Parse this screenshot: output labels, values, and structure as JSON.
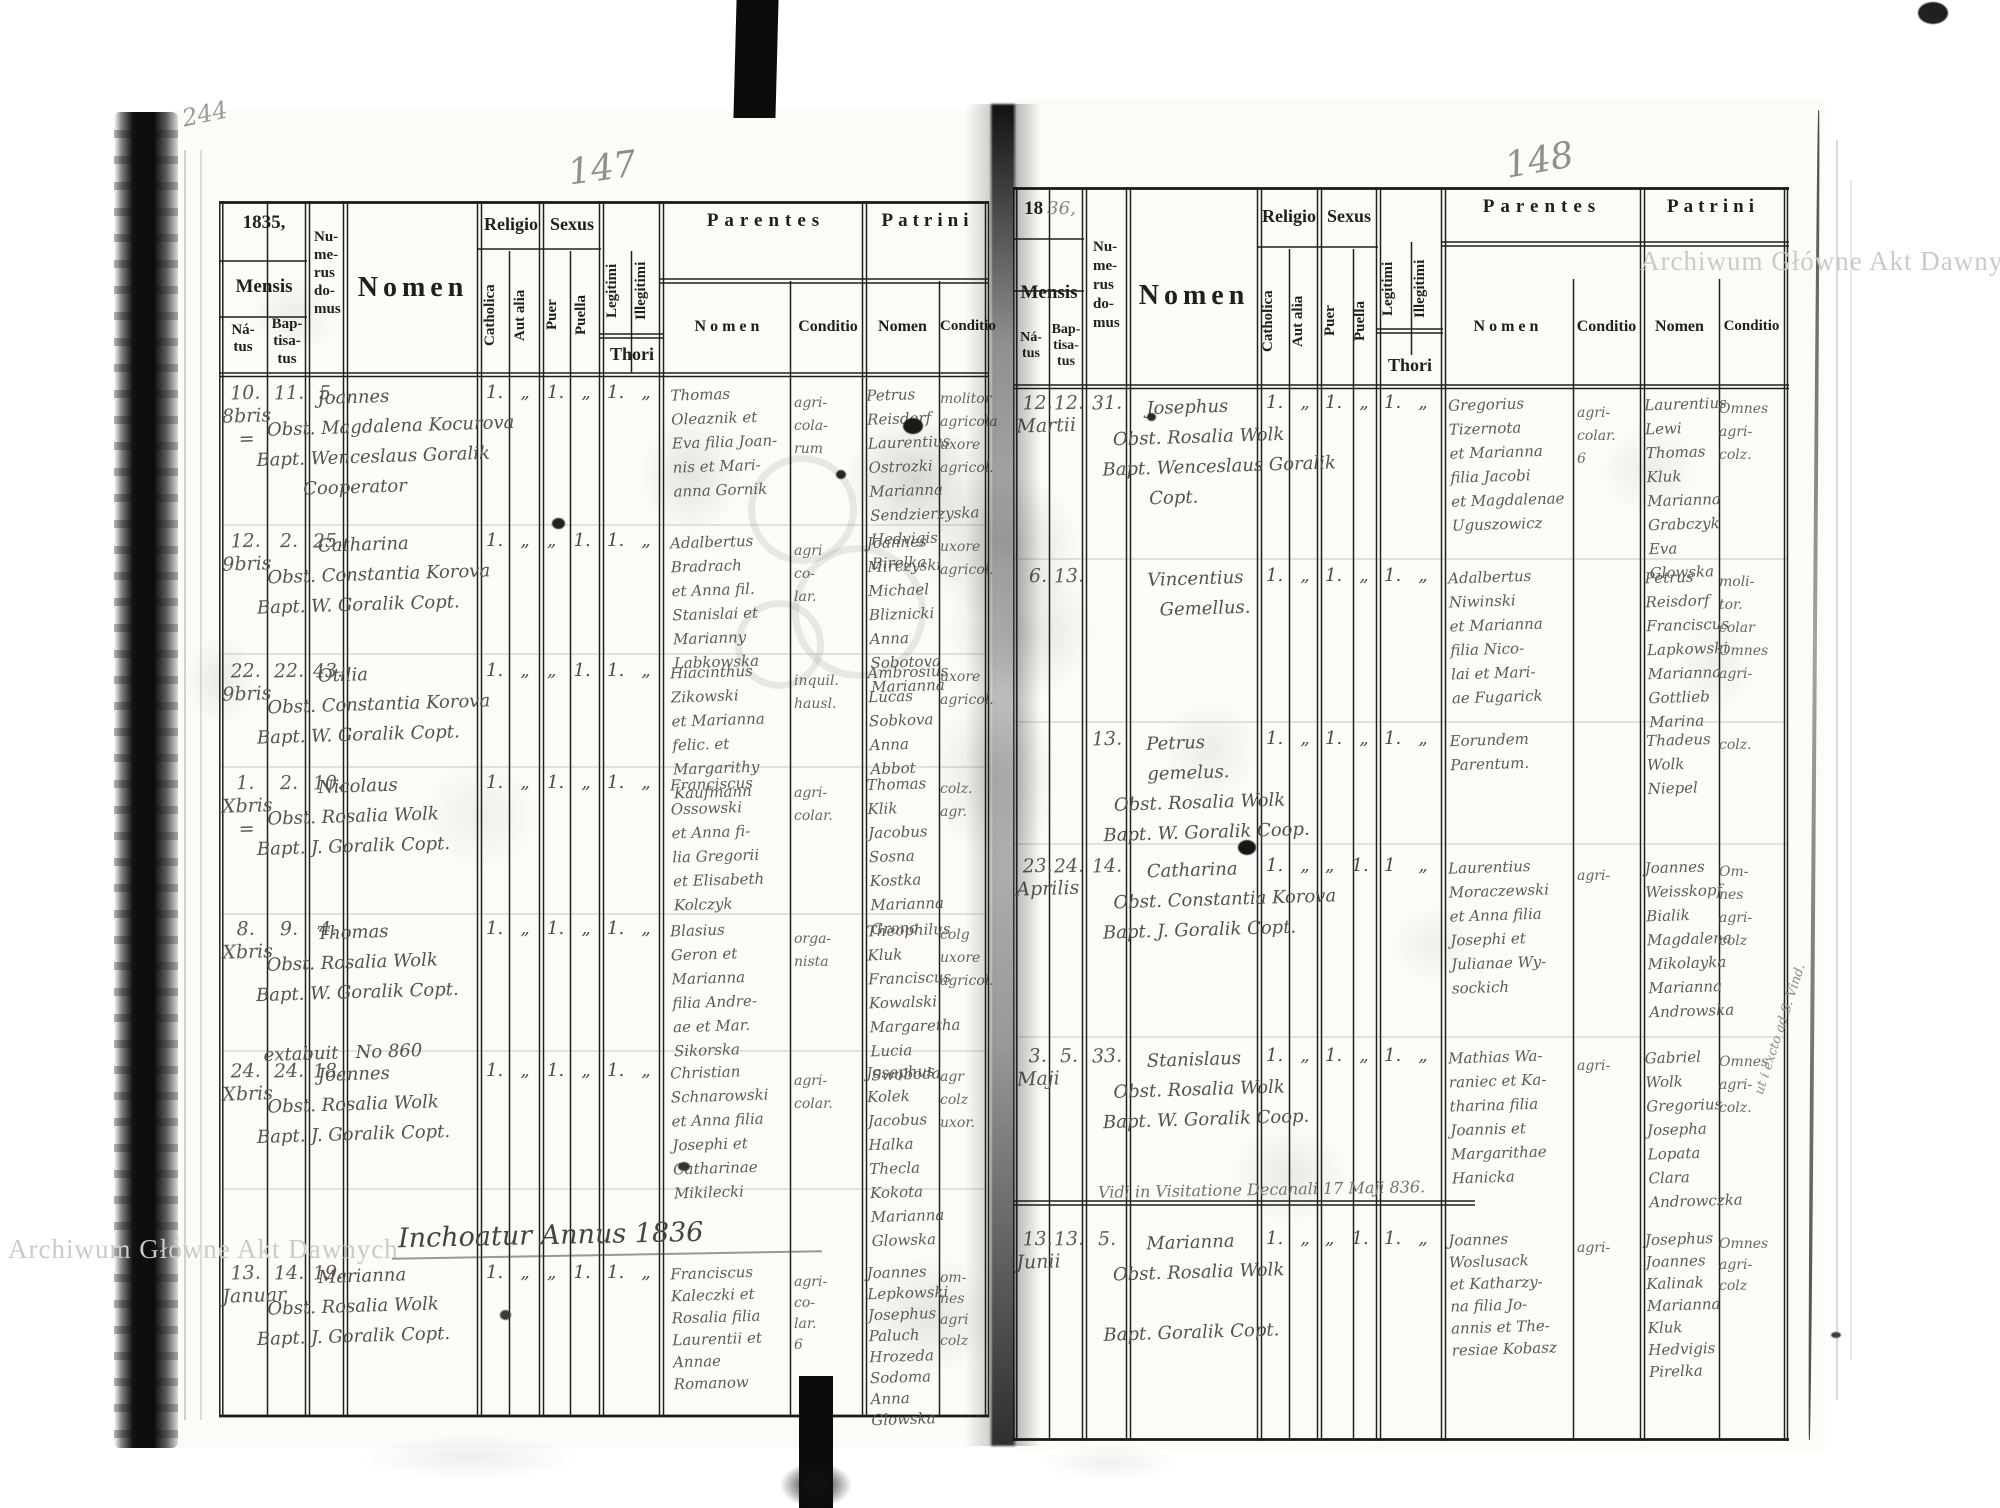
{
  "archive_watermark": {
    "text": "Archiwum Główne Akt Dawnych"
  },
  "headers": {
    "mensis": "Mensis",
    "natus": "Ná-\ntus",
    "baptisatus": "Bap-\ntisa-\ntus",
    "numerus_domus": "Nu-\nme-\nrus\ndo-\nmus",
    "nomen": "Nomen",
    "religio": "Religio",
    "catholica": "Catholica",
    "aut_alia": "Aut alia",
    "sexus": "Sexus",
    "puer": "Puer",
    "puella": "Puella",
    "legitimi": "Legitimi",
    "illegitimi": "Illegitimi",
    "thori": "Thori",
    "parentes": "Parentes",
    "patrini": "Patrini",
    "sub_nomen": "Nomen",
    "sub_conditio": "Conditio"
  },
  "page_left": {
    "corner_mark": "244",
    "page_number": "147",
    "year": "1835,",
    "section_note": "Inchoatur Annus 1836",
    "rows": [
      {
        "natus": "10.\n8bris\n=",
        "baptisatus": "11.",
        "domus": "5.",
        "entry": "           Joannes\n  Obst. Magdalena Kocurova\nBapt. Wenceslaus Goralik\n        Cooperator",
        "religio": "1.   „",
        "sexus": "1.   „",
        "thori": "1.   „",
        "parentes": "Thomas\nOleaznik et\nEva filia Joan-\nnis et Mari-\nanna Gornik",
        "parentes_conditio": "agri-\ncola-\nrum",
        "patrini": "Petrus\nReisdorf\nLaurentius\nOstrozki\nMarianna\nSendzierzyska\nHedvigis\nBirelka",
        "patrini_conditio": "molitor\nagricola\nuxore\nagricol."
      },
      {
        "natus": "12.\n9bris",
        "baptisatus": "2.",
        "domus": "25.",
        "entry": "           Catharina\n  Obst. Constantia Korova\nBapt. W. Goralik Copt.",
        "religio": "1.   „",
        "sexus": "„   1.",
        "thori": "1.   „",
        "parentes": "Adalbertus\nBradrach\net Anna fil.\nStanislai et\nMarianny\nLabkowska",
        "parentes_conditio": "agri\nco-\nlar.",
        "patrini": "Joannes\nMirczyski\nMichael\nBliznicki\nAnna\nSobotova\nMarianna",
        "patrini_conditio": "uxore\nagricol."
      },
      {
        "natus": "22.\n9bris",
        "baptisatus": "22.",
        "domus": "43.",
        "entry": "           Otilia\n  Obst. Constantia Korova\nBapt. W. Goralik Copt.",
        "religio": "1.   „",
        "sexus": "„   1.",
        "thori": "1.   „",
        "parentes": "Hiacinthus\nZikowski\net Marianna\nfelic. et\nMargarithy\nKaufmann",
        "parentes_conditio": "inquil.\nhausl.",
        "patrini": "Ambrosius\nLucas\nSobkova\nAnna\nAbbot",
        "patrini_conditio": "uxore\nagricol."
      },
      {
        "natus": "1.\nXbris\n=",
        "baptisatus": "2.",
        "domus": "10.",
        "entry": "           Nicolaus\n  Obst. Rosalia Wolk\nBapt. J. Goralik Copt.",
        "religio": "1.   „",
        "sexus": "1.   „",
        "thori": "1.   „",
        "parentes": "Franciscus\nOssowski\net Anna fi-\nlia Gregorii\net Elisabeth\nKolczyk",
        "parentes_conditio": "agri-\ncolar.",
        "patrini": "Thomas\nKlik\nJacobus\nSosna\nKostka\nMarianna\nGrono",
        "patrini_conditio": "colz.\nagr."
      },
      {
        "natus": "8.\nXbris",
        "baptisatus": "9.",
        "domus": "4.",
        "entry": "           Thomas\n  Obst. Rosalia Wolk\nBapt. W. Goralik Copt.\n\n extabuit   No 860",
        "religio": "1.   „",
        "sexus": "1.   „",
        "thori": "1.   „",
        "parentes": "Blasius\nGeron et\nMarianna\nfilia Andre-\nae et Mar.\nSikorska",
        "parentes_conditio": "orga-\nnista",
        "patrini": "Theophilus\nKluk\nFranciscus\nKowalski\nMargaretha\nLucia\nSwoboda",
        "patrini_conditio": "colg\nuxore\nagricol."
      },
      {
        "natus": "24.\nXbris",
        "baptisatus": "24.",
        "domus": "18.",
        "entry": "           Joannes\n  Obst. Rosalia Wolk\nBapt. J. Goralik Copt.",
        "religio": "1.   „",
        "sexus": "1.   „",
        "thori": "1.   „",
        "parentes": "Christian\nSchnarowski\net Anna filia\nJosephi et\nCatharinae\nMikilecki",
        "parentes_conditio": "agri-\ncolar.",
        "patrini": "Josephus\nKolek\nJacobus\nHalka\nThecla\nKokota\nMarianna\nGlowska",
        "patrini_conditio": "agr\ncolz\nuxor."
      },
      {
        "natus": "13.\nJanuar",
        "baptisatus": "14.",
        "domus": "19.",
        "entry": "           Marianna\n  Obst. Rosalia Wolk\nBapt. J. Goralik Copt.",
        "religio": "1.   „",
        "sexus": "„   1.",
        "thori": "1.   „",
        "parentes": "Franciscus\nKaleczki et\nRosalia filia\nLaurentii et\nAnnae\nRomanow",
        "parentes_conditio": "agri-\nco-\nlar.\n6",
        "patrini": "Joannes\nLepkowski\nJosephus\nPaluch\nHrozeda\nSodoma\nAnna\nGlowska",
        "patrini_conditio": "om-\nnes\nagri\ncolz"
      }
    ]
  },
  "page_right": {
    "page_number": "148",
    "year_printed": "18",
    "year_hand": "36,",
    "visitation_note": "Vidi in Visitatione Decanali 17 Maji 836.",
    "margin_note": "ut i excto ad S. Vind.",
    "rows": [
      {
        "natus": "12.\nMartii",
        "baptisatus": "12.",
        "domus": "31.",
        "entry": "        Josephus\n  Obst. Rosalia Wolk\nBapt. Wenceslaus Goralik\n        Copt.",
        "religio": "1.   „",
        "sexus": "1.   „",
        "thori": "1.   „",
        "parentes": "Gregorius\nTizernota\net Marianna\nfilia Jacobi\net Magdalenae\nUguszowicz",
        "parentes_conditio": "agri-\ncolar.\n6",
        "patrini": "Laurentius\nLewi\nThomas\nKluk\nMarianna\nGrabczyk\nEva\nGlowska",
        "patrini_conditio": "Omnes\nagri-\ncolz."
      },
      {
        "natus": "6.",
        "baptisatus": "13.",
        "domus": "",
        "entry": "        Vincentius\n          Gemellus.",
        "religio": "1.   „",
        "sexus": "1.   „",
        "thori": "1.   „",
        "parentes": "Adalbertus\nNiwinski\net Marianna\nfilia Nico-\nlai et Mari-\nae Fugarick",
        "parentes_conditio": "",
        "patrini": "Petrus\nReisdorf\nFranciscus\nLapkowski\nMarianna\nGottlieb\nMarina",
        "patrini_conditio": "moli-\ntor.\ncolar\nOmnes\nagri-"
      },
      {
        "natus": "",
        "baptisatus": "",
        "domus": "13.",
        "entry": "        Petrus\n        gemelus.\n  Obst. Rosalia Wolk\nBapt. W. Goralik Coop.",
        "religio": "1.   „",
        "sexus": "1.   „",
        "thori": "1.   „",
        "parentes": "Eorundem\nParentum.",
        "parentes_conditio": "",
        "patrini": "Thadeus\nWolk\nNiepel",
        "patrini_conditio": "colz."
      },
      {
        "natus": "23.\nAprilis",
        "baptisatus": "24.",
        "domus": "14.",
        "entry": "        Catharina\n  Obst. Constantia Korova\nBapt. J. Goralik Copt.",
        "religio": "1.   „",
        "sexus": "„   1.",
        "thori": "1    „",
        "parentes": "Laurentius\nMoraczewski\net Anna filia\nJosephi et\nJulianae Wy-\nsockich",
        "parentes_conditio": "agri-",
        "patrini": "Joannes\nWeisskopf\nBialik\nMagdalena\nMikolayka\nMarianna\nAndrowska",
        "patrini_conditio": "Om-\nnes\nagri-\ncolz"
      },
      {
        "natus": "3.\nMaji",
        "baptisatus": "5.",
        "domus": "33.",
        "entry": "        Stanislaus\n  Obst. Rosalia Wolk\nBapt. W. Goralik Coop.",
        "religio": "1.   „",
        "sexus": "1.   „",
        "thori": "1.   „",
        "parentes": "Mathias Wa-\nraniec et Ka-\ntharina filia\nJoannis et\nMargarithae\nHanicka",
        "parentes_conditio": "agri-",
        "patrini": "Gabriel\nWolk\nGregorius\nJosepha\nLopata\nClara\nAndrowczka",
        "patrini_conditio": "Omnes\nagri-\ncolz."
      },
      {
        "natus": "13.\nJunii",
        "baptisatus": "13.",
        "domus": "5.",
        "entry": "        Marianna\n  Obst. Rosalia Wolk\n\nBapt. Goralik Copt.",
        "religio": "1.   „",
        "sexus": "„   1.",
        "thori": "1.   „",
        "parentes": "Joannes\nWoslusack\net Katharzy-\nna filia Jo-\nannis et The-\nresiae Kobasz",
        "parentes_conditio": "agri-",
        "patrini": "Josephus\nJoannes\nKalinak\nMarianna\nKluk\nHedvigis\nPirelka",
        "patrini_conditio": "Omnes\nagri-\ncolz"
      }
    ]
  }
}
